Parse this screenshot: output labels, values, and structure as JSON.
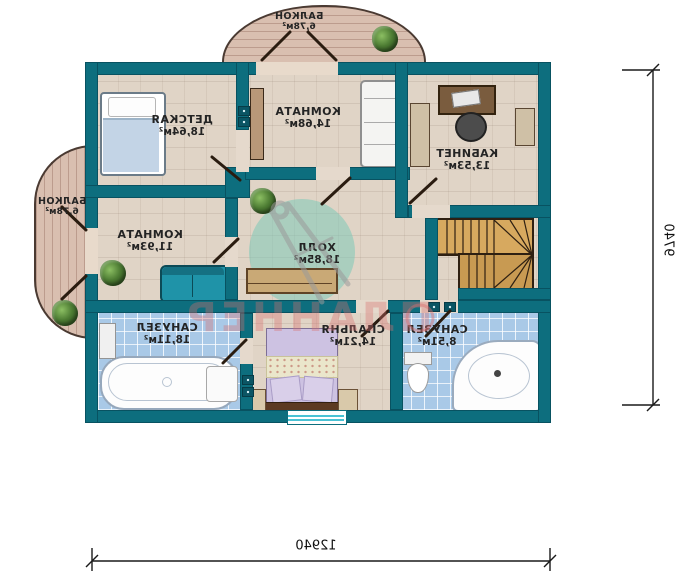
{
  "plan": {
    "rooms": [
      {
        "id": "balcony-top",
        "name": "БАЛКОН",
        "area": "6,78м²"
      },
      {
        "id": "balcony-left",
        "name": "БАЛКОН",
        "area": "6,78м²"
      },
      {
        "id": "nursery",
        "name": "ДЕТСКАЯ",
        "area": "18,64м²"
      },
      {
        "id": "room-top",
        "name": "КОМНАТА",
        "area": "14,68м²"
      },
      {
        "id": "study",
        "name": "КАБИНЕТ",
        "area": "13,53м²"
      },
      {
        "id": "room-mid",
        "name": "КОМНАТА",
        "area": "11,93м²"
      },
      {
        "id": "hall",
        "name": "ХОЛЛ",
        "area": "18,85м²"
      },
      {
        "id": "bathroom-left",
        "name": "САНУЗЕЛ",
        "area": "18,11м²"
      },
      {
        "id": "bedroom",
        "name": "СПАЛЬНЯ",
        "area": "14,21м²"
      },
      {
        "id": "bathroom-right",
        "name": "САНУЗЕЛ",
        "area": "8,51м²"
      }
    ],
    "dimensions": {
      "bottom": "12940",
      "right": "9740"
    },
    "watermark": {
      "text": "ПЛАННЕР"
    },
    "colors": {
      "wall": "#0d6e7e",
      "floor": "#e0d4c6",
      "bath_tile": "#b7d4ee",
      "balcony_wood": "#d9bfb0",
      "sofa_accent": "#1f93a8"
    }
  }
}
